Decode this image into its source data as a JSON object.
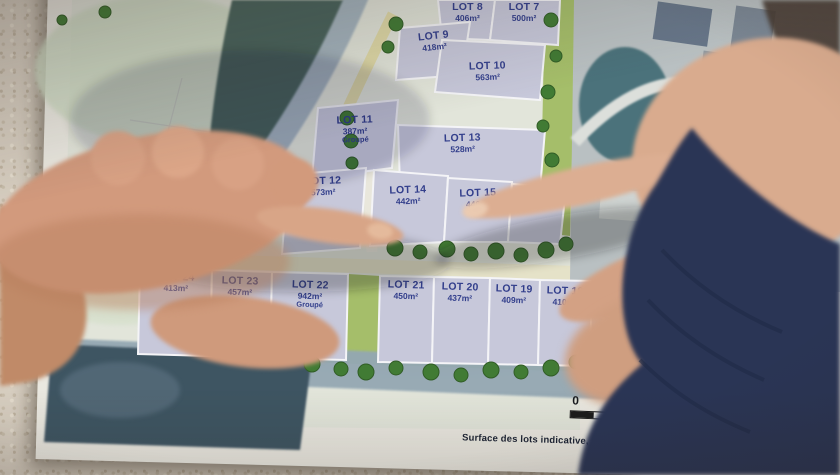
{
  "map": {
    "upper_lots": [
      {
        "name": "LOT 8",
        "area": "406m²"
      },
      {
        "name": "LOT 7",
        "area": "500m²"
      },
      {
        "name": "LOT 9",
        "area": "418m²"
      },
      {
        "name": "LOT 10",
        "area": "563m²"
      },
      {
        "name": "LOT 11",
        "area": "387m²",
        "note": "Groupé"
      },
      {
        "name": "LOT 13",
        "area": "528m²"
      },
      {
        "name": "LOT 12",
        "area": "573m²"
      },
      {
        "name": "LOT 14",
        "area": "442m²"
      },
      {
        "name": "LOT 15",
        "area": "446m²"
      },
      {
        "name": "LOT 16",
        "area": ""
      }
    ],
    "lower_lots": [
      {
        "name": "LOT 24",
        "area": "413m²"
      },
      {
        "name": "LOT 23",
        "area": "457m²"
      },
      {
        "name": "LOT 22",
        "area": "942m²",
        "note": "Groupé"
      },
      {
        "name": "LOT 21",
        "area": "450m²"
      },
      {
        "name": "LOT 20",
        "area": "437m²"
      },
      {
        "name": "LOT 19",
        "area": "409m²"
      },
      {
        "name": "LOT 18",
        "area": "410m²"
      }
    ],
    "legend": {
      "scale_start": "0",
      "scale_end": "50",
      "north_label": "N",
      "note": "Surface des lots indicative, se référer au plan de bornage du géomètre"
    },
    "aerial_label_partial": "AD"
  },
  "colors": {
    "lot_fill": "#c7c8db",
    "lot_text": "#333f8c",
    "road_yellow": "#dfd9a2",
    "green_strip": "#a4bf66",
    "tree_green": "#3f7c31",
    "teal_field": "#47635b",
    "lower_road": "#93a7b4",
    "dark_field": "#3d5464",
    "sleeve_navy": "#2b3654",
    "skin": "#d29a7d"
  }
}
